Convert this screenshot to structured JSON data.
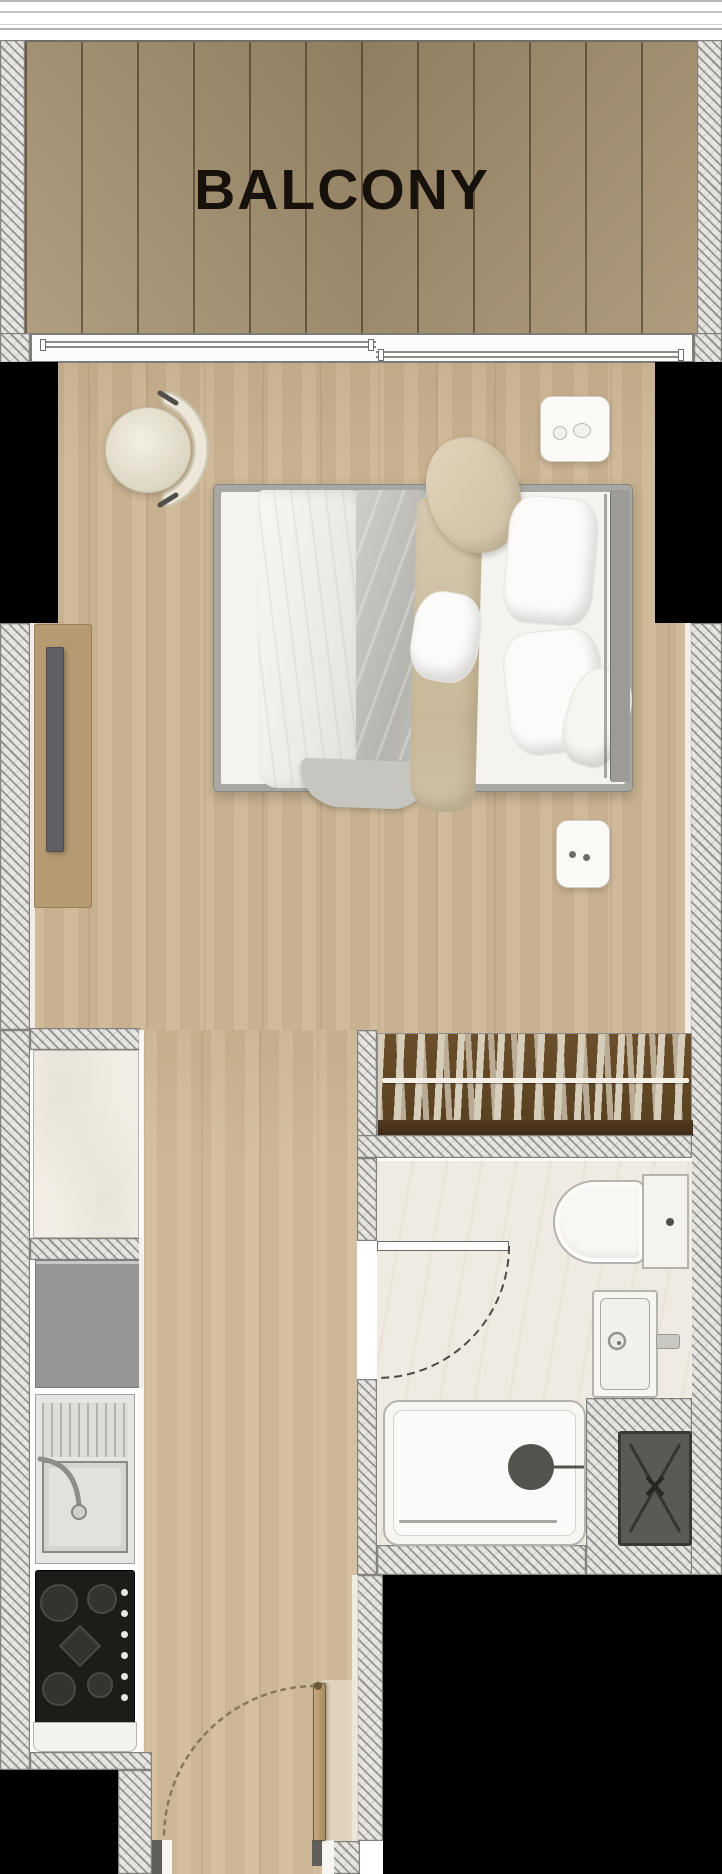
{
  "meta": {
    "type": "apartment-floor-plan",
    "canvas": {
      "width": 722,
      "height": 1874
    }
  },
  "rooms": {
    "balcony": {
      "label": "BALCONY",
      "deck": "wood-plank-decking",
      "boundary": "glass-railing-top, sliding-door-bottom"
    },
    "main_room": {
      "fixtures": [
        "double-bed",
        "nightstand-top",
        "nightstand-bottom",
        "round-armchair",
        "tv-console",
        "wall-tv"
      ]
    },
    "kitchen": {
      "fixtures": [
        "marble-counter",
        "refrigerator",
        "stainless-sink-with-faucet",
        "gas-hob-4-burners",
        "base-cabinet"
      ]
    },
    "wardrobe": {
      "type": "built-in-closet-with-hanging-rail"
    },
    "bathroom": {
      "fixtures": [
        "toilet-with-tank",
        "washbasin",
        "bathtub-with-drain",
        "dark-shower-mat",
        "swing-door"
      ]
    },
    "entry": {
      "fixtures": [
        "entry-door-leaf",
        "door-swing-arc"
      ]
    }
  },
  "palette": {
    "wall_hatch": "#e6e5e2",
    "hatch_line": "#83827e",
    "deck_wood": "#a6916f",
    "floor_wood": "#cdb795",
    "corridor_wood": "#d2bd9b",
    "void_black": "#000000",
    "fixture_white": "#f8f7f4",
    "marble": "#f2eee5",
    "wardrobe_brown": "#5e4526",
    "stove_black": "#1c1c19",
    "appliance_gray": "#969694",
    "mat_gray": "#5a5955",
    "bed_frame_gray": "#a9a7a3",
    "beige_textile": "#d6c9af"
  }
}
